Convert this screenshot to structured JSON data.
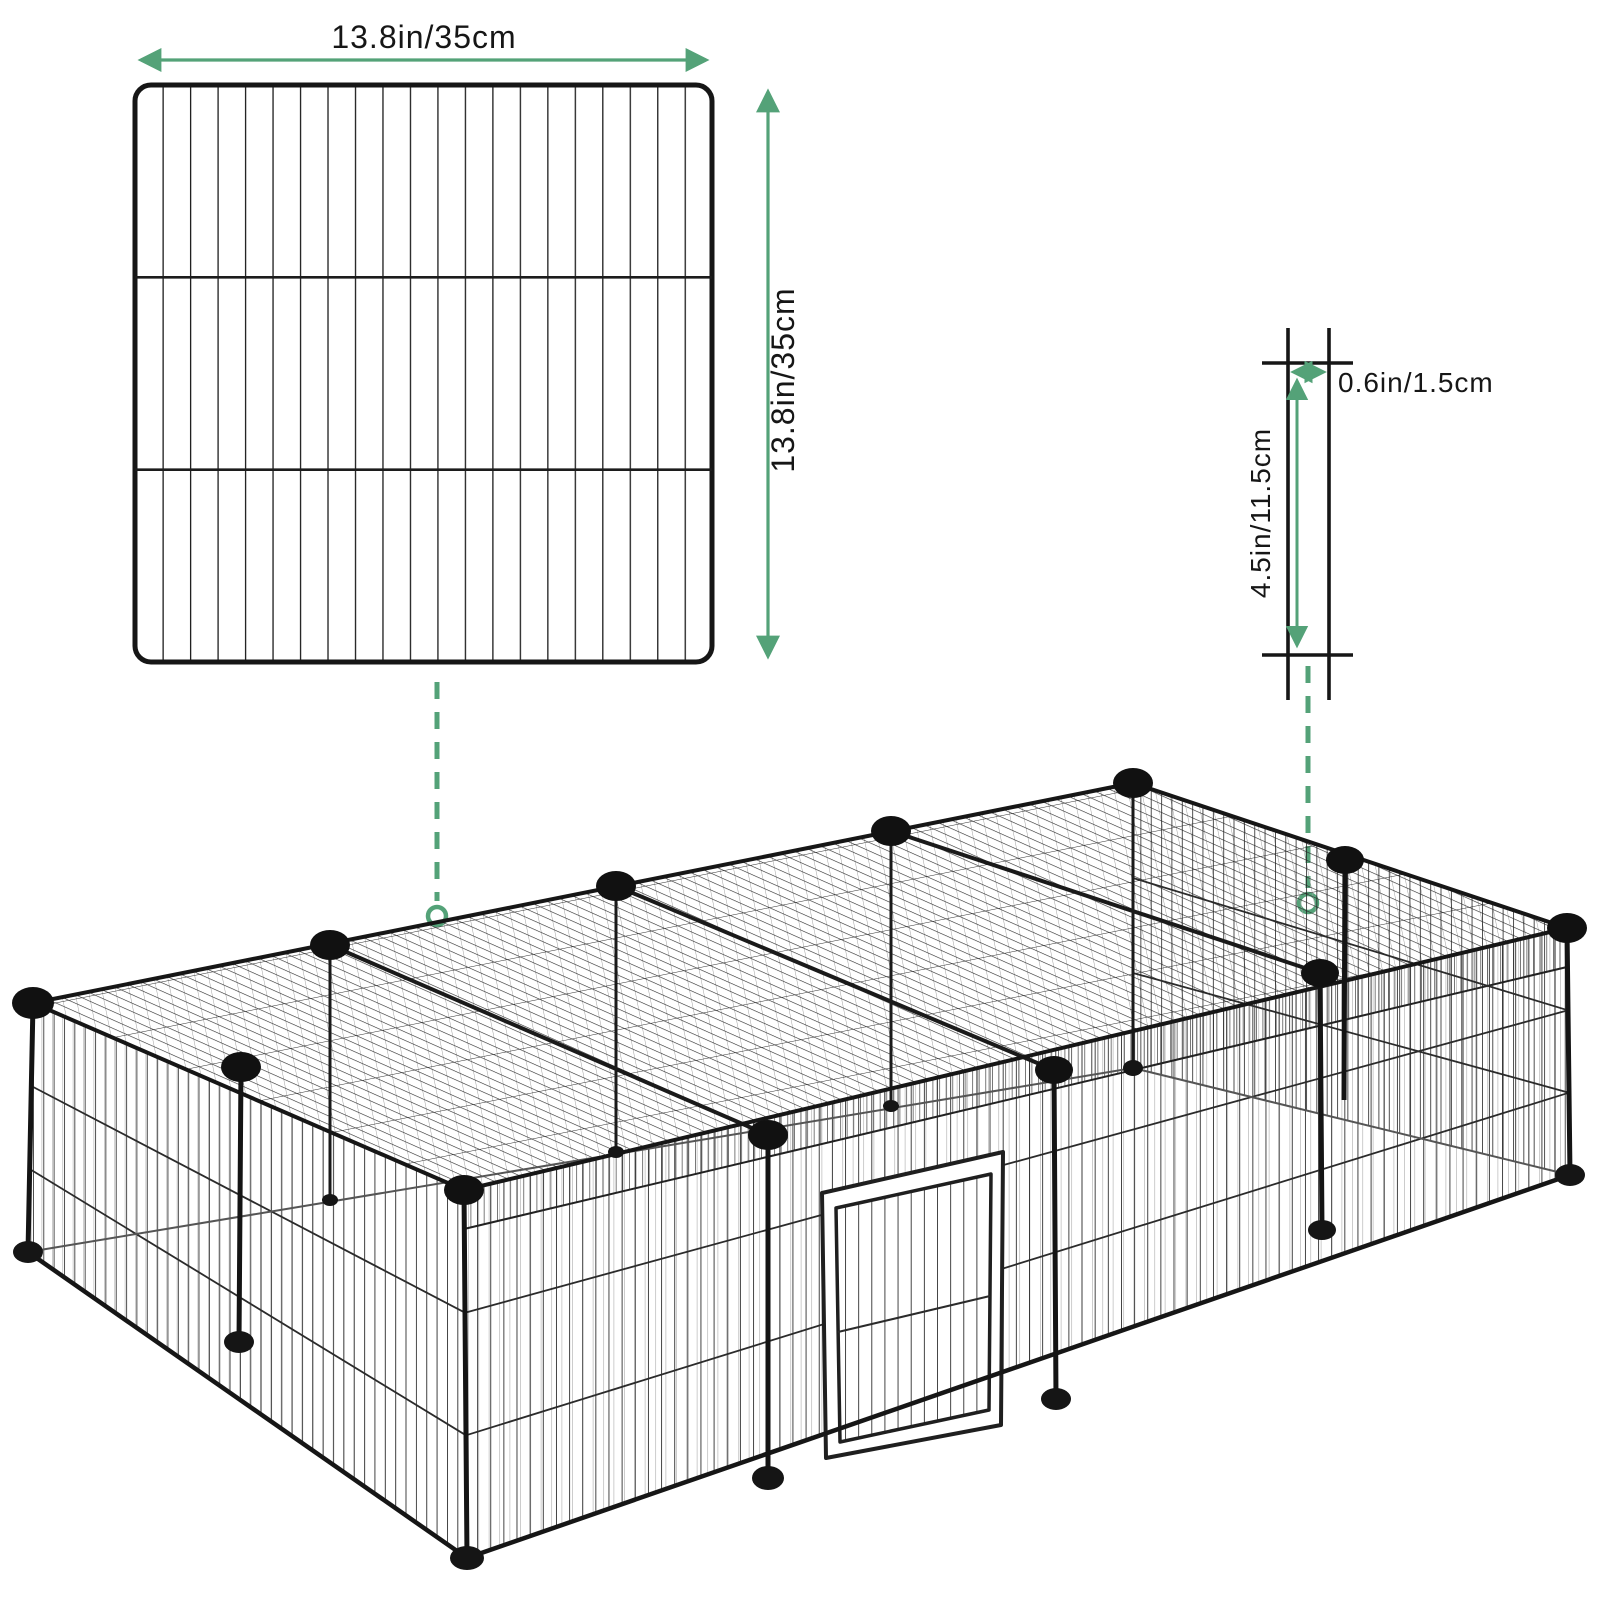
{
  "colors": {
    "accent_green": "#54a278",
    "wire_black": "#1f1f1f",
    "ink": "#161616",
    "connector_black": "#111111",
    "seen_through_gray": "#a0a0a0"
  },
  "panel_view": {
    "width_label": "13.8in/35cm",
    "height_label": "13.8in/35cm"
  },
  "grid_detail": {
    "cell_width_label": "0.6in/1.5cm",
    "cell_height_label": "4.5in/11.5cm"
  }
}
